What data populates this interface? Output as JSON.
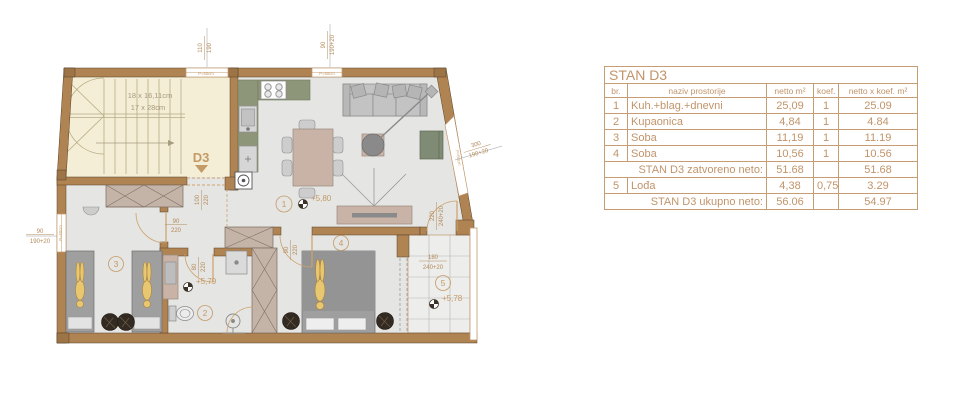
{
  "plan": {
    "unit": "D3",
    "stairs": {
      "note1": "18 x 16,11cm",
      "note2": "17 x 28cm"
    },
    "parapet": "P=50cm",
    "rooms": {
      "living": {
        "num": "1",
        "level": "+5,80"
      },
      "bath": {
        "num": "2",
        "level": "+5,79"
      },
      "bed3": {
        "num": "3"
      },
      "bed4": {
        "num": "4"
      },
      "loggia": {
        "num": "5",
        "level": "+5,78"
      }
    },
    "dims": {
      "top1": {
        "a": "110",
        "b": "190"
      },
      "top2": {
        "a": "90",
        "b": "190+20"
      },
      "left": {
        "a": "90",
        "b": "190+20"
      },
      "slant": {
        "a": "300",
        "b": "190+20"
      },
      "entry": {
        "a": "100",
        "b": "220"
      },
      "bed3_door": {
        "a": "90",
        "b": "220"
      },
      "bath_door": {
        "a": "80",
        "b": "220"
      },
      "bed4_door": {
        "a": "90",
        "b": "220"
      },
      "loggia_door": {
        "a": "220",
        "b": "240+20"
      },
      "loggia_open": {
        "a": "180",
        "b": "240+20"
      }
    }
  },
  "table": {
    "title": "STAN D3",
    "headers": {
      "br": "br.",
      "name": "naziv prostorije",
      "netto": "netto m²",
      "koef": "koef.",
      "total": "netto x koef. m²"
    },
    "rows": [
      {
        "br": "1",
        "name": "Kuh.+blag.+dnevni",
        "netto": "25,09",
        "koef": "1",
        "total": "25.09"
      },
      {
        "br": "2",
        "name": "Kupaonica",
        "netto": "4,84",
        "koef": "1",
        "total": "4.84"
      },
      {
        "br": "3",
        "name": "Soba",
        "netto": "11,19",
        "koef": "1",
        "total": "11.19"
      },
      {
        "br": "4",
        "name": "Soba",
        "netto": "10,56",
        "koef": "1",
        "total": "10.56"
      }
    ],
    "subtotal": {
      "label": "STAN D3 zatvoreno neto:",
      "netto": "51.68",
      "total": "51.68"
    },
    "row5": {
      "br": "5",
      "name": "Lođa",
      "netto": "4,38",
      "koef": "0,75",
      "total": "3.29"
    },
    "grand": {
      "label": "STAN D3 ukupno neto:",
      "netto": "56.06",
      "total": "54.97"
    }
  },
  "colors": {
    "accent": "#c1946a",
    "wall": "#b08352",
    "stair_bg": "#f4eed6",
    "floor": "#e5e5e3",
    "kitchen": "#8e9679",
    "wood": "#c9b3a7",
    "gold": "#e9c771"
  }
}
